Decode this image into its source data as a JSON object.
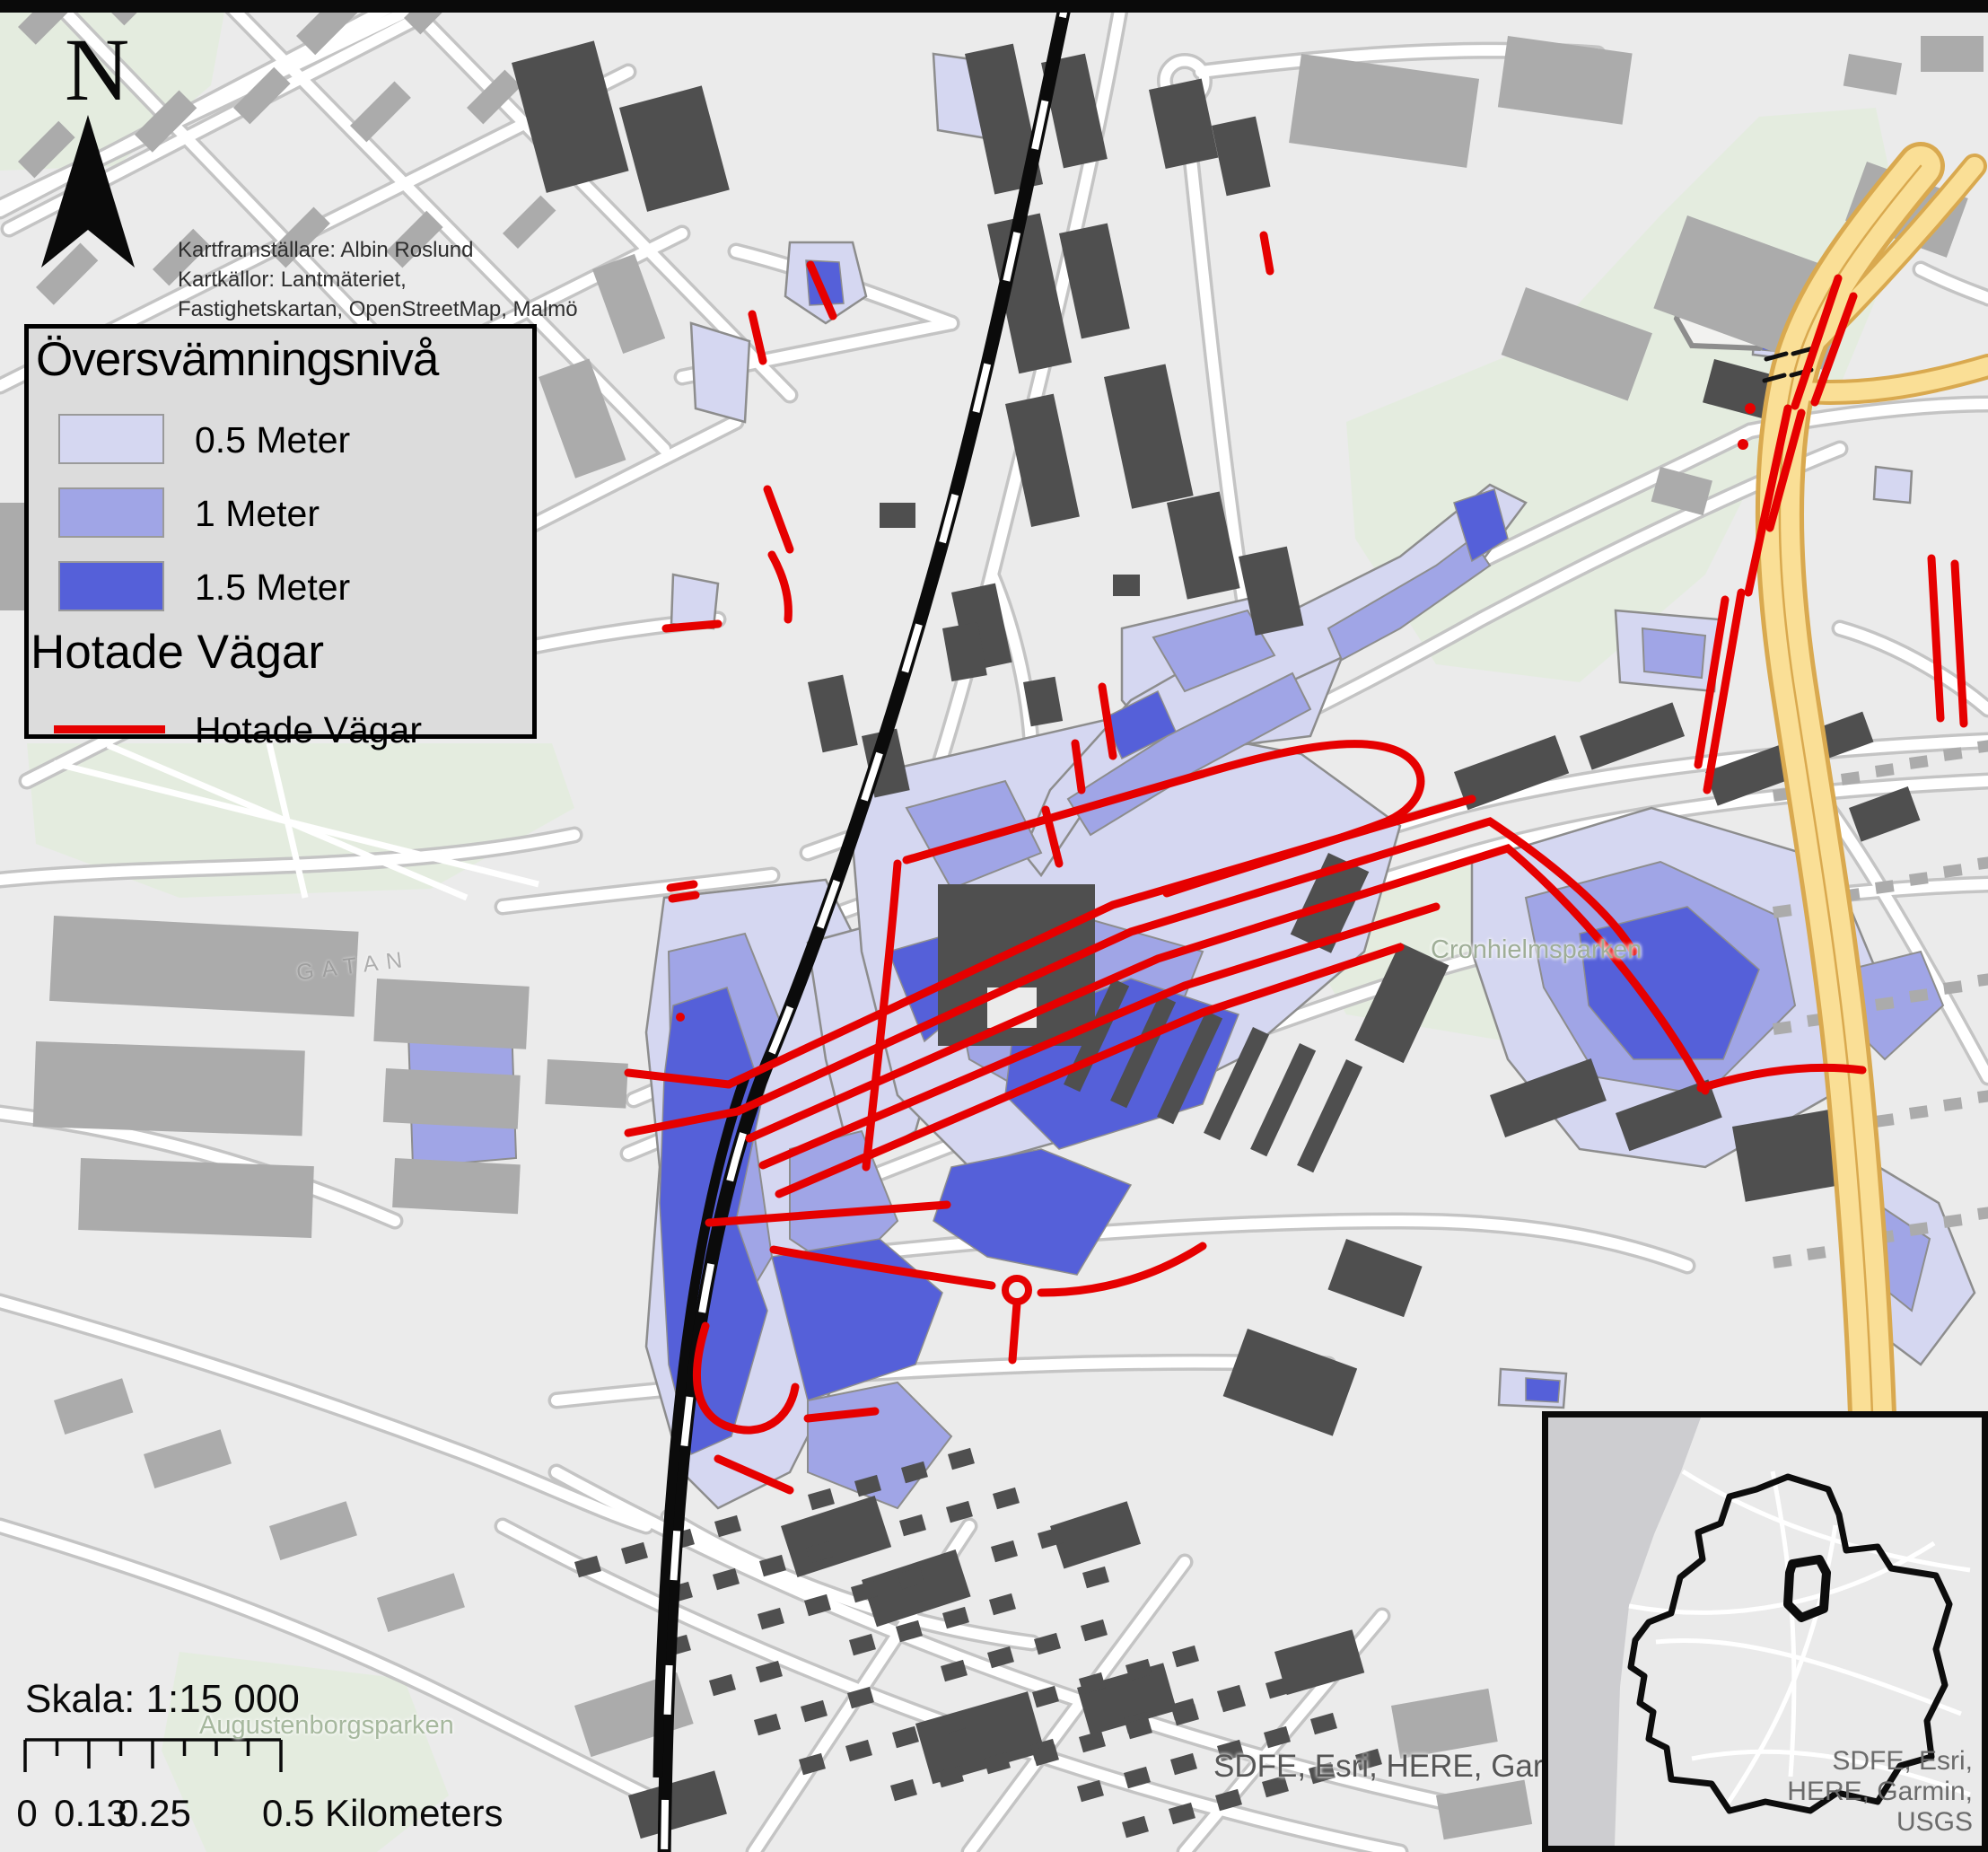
{
  "north_label": "N",
  "attribution": {
    "line1": "Kartframställare: Albin Roslund",
    "line2": "Kartkällor: Lantmäteriet,",
    "line3": "Fastighetskartan, OpenStreetMap, Malmö stad"
  },
  "legend": {
    "title": "Översvämningsnivå",
    "items": [
      {
        "label": "0.5 Meter",
        "color": "#d5d7f1"
      },
      {
        "label": "1 Meter",
        "color": "#a0a5e6"
      },
      {
        "label": "1.5 Meter",
        "color": "#5560d9"
      }
    ],
    "section2_title": "Hotade Vägar",
    "line_item": {
      "label": "Hotade Vägar",
      "color": "#e60000"
    }
  },
  "scale": {
    "text": "Skala: 1:15 000",
    "ticks": [
      "0",
      "0.13",
      "0.25"
    ],
    "end_label": "0.5 Kilometers"
  },
  "map_labels": {
    "park_right": "Cronhielmsparken",
    "park_bottom": "Augustenborgsparken",
    "street_fragment": "GATAN"
  },
  "credits": {
    "main": "SDFE, Esri, HERE, Garmin",
    "inset": [
      "SDFE, Esri,",
      "HERE, Garmin,",
      "USGS"
    ]
  },
  "colors": {
    "background": "#ebebeb",
    "flood_05m": "#d5d7f1",
    "flood_1m": "#a0a5e6",
    "flood_15m": "#5560d9",
    "threatened_road": "#e60000",
    "motorway_fill": "#fadf96",
    "motorway_casing": "#d9a94f",
    "park": "#e4ecdf",
    "building_dark": "#4f4f4f",
    "building_light": "#ababab",
    "railway": "#0b0b0b"
  }
}
